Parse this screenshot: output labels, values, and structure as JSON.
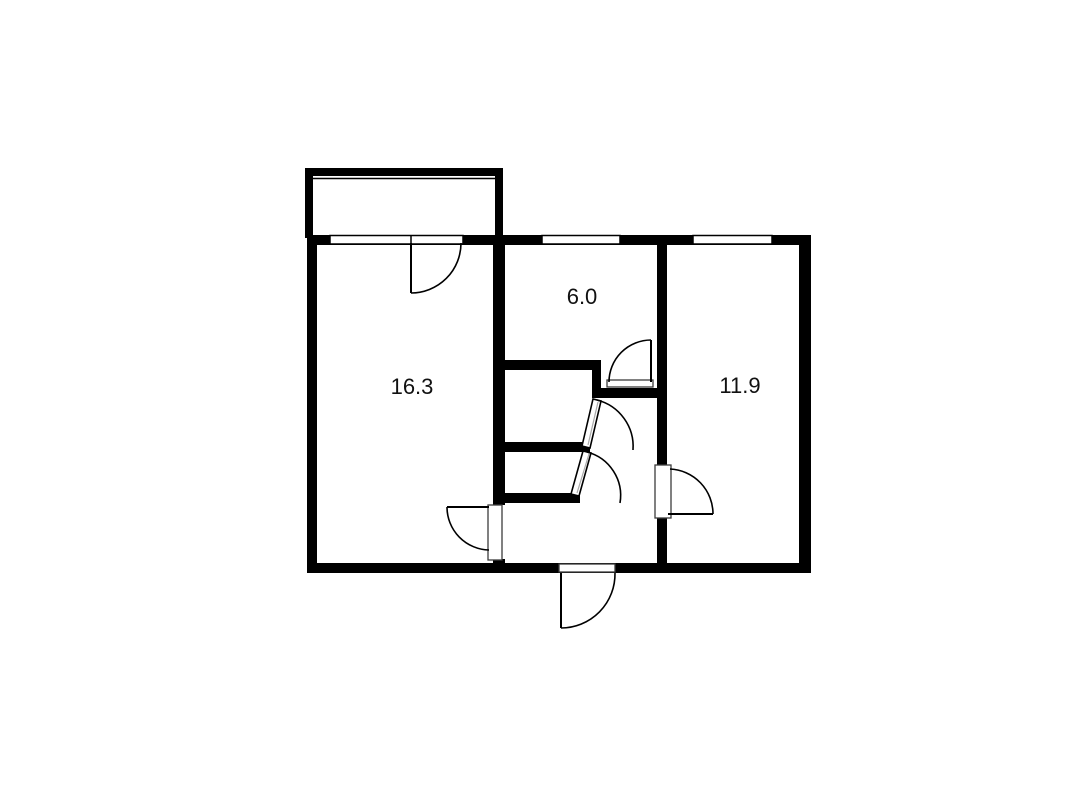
{
  "title": "apartment-floor-plan",
  "background": "#ffffff",
  "ink": "#000000",
  "panel_stroke": "#3c3c3c",
  "inner_stroke": "#aaaaaa",
  "canvas": {
    "width": 1080,
    "height": 785
  },
  "rooms": [
    {
      "name": "room-living",
      "area_label": "16.3",
      "label_x": 412,
      "label_y": 394
    },
    {
      "name": "room-kitchen",
      "area_label": "6.0",
      "label_x": 582,
      "label_y": 304
    },
    {
      "name": "room-bedroom",
      "area_label": "11.9",
      "label_x": 740,
      "label_y": 393
    }
  ],
  "walls": [
    {
      "name": "balcony-wall-left",
      "x": 305,
      "y": 168,
      "w": 8,
      "h": 70
    },
    {
      "name": "balcony-wall-top",
      "x": 305,
      "y": 168,
      "w": 198,
      "h": 8
    },
    {
      "name": "balcony-wall-right",
      "x": 495,
      "y": 168,
      "w": 8,
      "h": 70
    },
    {
      "name": "outer-wall-top",
      "x": 307,
      "y": 235,
      "w": 504,
      "h": 10
    },
    {
      "name": "outer-wall-left",
      "x": 307,
      "y": 235,
      "w": 10,
      "h": 338
    },
    {
      "name": "outer-wall-right",
      "x": 799,
      "y": 235,
      "w": 12,
      "h": 338
    },
    {
      "name": "outer-wall-bottom",
      "x": 307,
      "y": 563,
      "w": 504,
      "h": 10
    },
    {
      "name": "wall-living-upper",
      "x": 493,
      "y": 240,
      "w": 12,
      "h": 265
    },
    {
      "name": "wall-living-lower",
      "x": 493,
      "y": 559,
      "w": 12,
      "h": 10
    },
    {
      "name": "wall-bedroom-upper",
      "x": 657,
      "y": 240,
      "w": 10,
      "h": 225
    },
    {
      "name": "wall-bedroom-lower",
      "x": 657,
      "y": 518,
      "w": 10,
      "h": 51
    },
    {
      "name": "wall-bath-top",
      "x": 493,
      "y": 360,
      "w": 108,
      "h": 10
    },
    {
      "name": "wall-bath-right-stub",
      "x": 592,
      "y": 370,
      "w": 9,
      "h": 28
    },
    {
      "name": "wall-hall-stub",
      "x": 601,
      "y": 388,
      "w": 66,
      "h": 10
    },
    {
      "name": "wall-bath-mid",
      "x": 493,
      "y": 442,
      "w": 97,
      "h": 10
    },
    {
      "name": "wall-bath-bottom",
      "x": 493,
      "y": 493,
      "w": 87,
      "h": 10
    }
  ],
  "windows": [
    {
      "name": "window-living",
      "x": 330,
      "y": 235.5,
      "w": 133,
      "h": 8.5
    },
    {
      "name": "window-kitchen",
      "x": 542,
      "y": 235.5,
      "w": 78,
      "h": 8.5
    },
    {
      "name": "window-bedroom",
      "x": 693,
      "y": 235.5,
      "w": 79,
      "h": 8.5
    }
  ],
  "thin_lines": [
    {
      "name": "balcony-railing",
      "x1": 313,
      "y1": 178.5,
      "x2": 495,
      "y2": 178.5
    },
    {
      "name": "window-living-tick",
      "x1": 411,
      "y1": 235.5,
      "x2": 411,
      "y2": 244
    }
  ],
  "door_panels": [
    {
      "name": "door-panel-living",
      "x": 488,
      "y": 505,
      "w": 14,
      "h": 55
    },
    {
      "name": "door-panel-bedroom",
      "x": 655,
      "y": 465,
      "w": 16,
      "h": 53
    },
    {
      "name": "door-sill-kitchen",
      "x": 607,
      "y": 380,
      "w": 46,
      "h": 7
    },
    {
      "name": "door-sill-entrance",
      "x": 559,
      "y": 564,
      "w": 56,
      "h": 8
    }
  ],
  "door_leaves": [
    {
      "name": "door-leaf-balcony",
      "x1": 411,
      "y1": 243,
      "x2": 411,
      "y2": 293
    },
    {
      "name": "door-leaf-kitchen",
      "x1": 651,
      "y1": 340,
      "x2": 651,
      "y2": 382
    },
    {
      "name": "door-leaf-living",
      "x1": 447,
      "y1": 507,
      "x2": 489,
      "y2": 507
    },
    {
      "name": "door-leaf-bedroom",
      "x1": 668,
      "y1": 514,
      "x2": 713,
      "y2": 514
    },
    {
      "name": "door-leaf-entrance",
      "x1": 561,
      "y1": 573,
      "x2": 561,
      "y2": 628
    }
  ],
  "door_leaf_polys": [
    {
      "name": "door-leaf-bath-upper",
      "points": "590,448 582,446 593,399 601,401",
      "ix1": 588,
      "iy1": 445,
      "ix2": 598,
      "iy2": 402
    },
    {
      "name": "door-leaf-bath-lower",
      "points": "579,496 571,494 583,451 591,453",
      "ix1": 577,
      "iy1": 493,
      "ix2": 589,
      "iy2": 454
    }
  ],
  "door_arcs": [
    {
      "name": "door-arc-balcony",
      "d": "M 411 293 A 50 50 0 0 0 461 243"
    },
    {
      "name": "door-arc-kitchen",
      "d": "M 651 340 A 42 42 0 0 0 609 382"
    },
    {
      "name": "door-arc-bath-upper",
      "d": "M 597 400 A 48 48 0 0 1 633 450"
    },
    {
      "name": "door-arc-bath-lower",
      "d": "M 587 452 A 45 45 0 0 1 620 503"
    },
    {
      "name": "door-arc-living",
      "d": "M 447 507 A 43 43 0 0 0 489 550"
    },
    {
      "name": "door-arc-bedroom",
      "d": "M 713 514 A 45 45 0 0 0 670 469"
    },
    {
      "name": "door-arc-entrance",
      "d": "M 561 628 A 54 54 0 0 0 615 573"
    }
  ]
}
